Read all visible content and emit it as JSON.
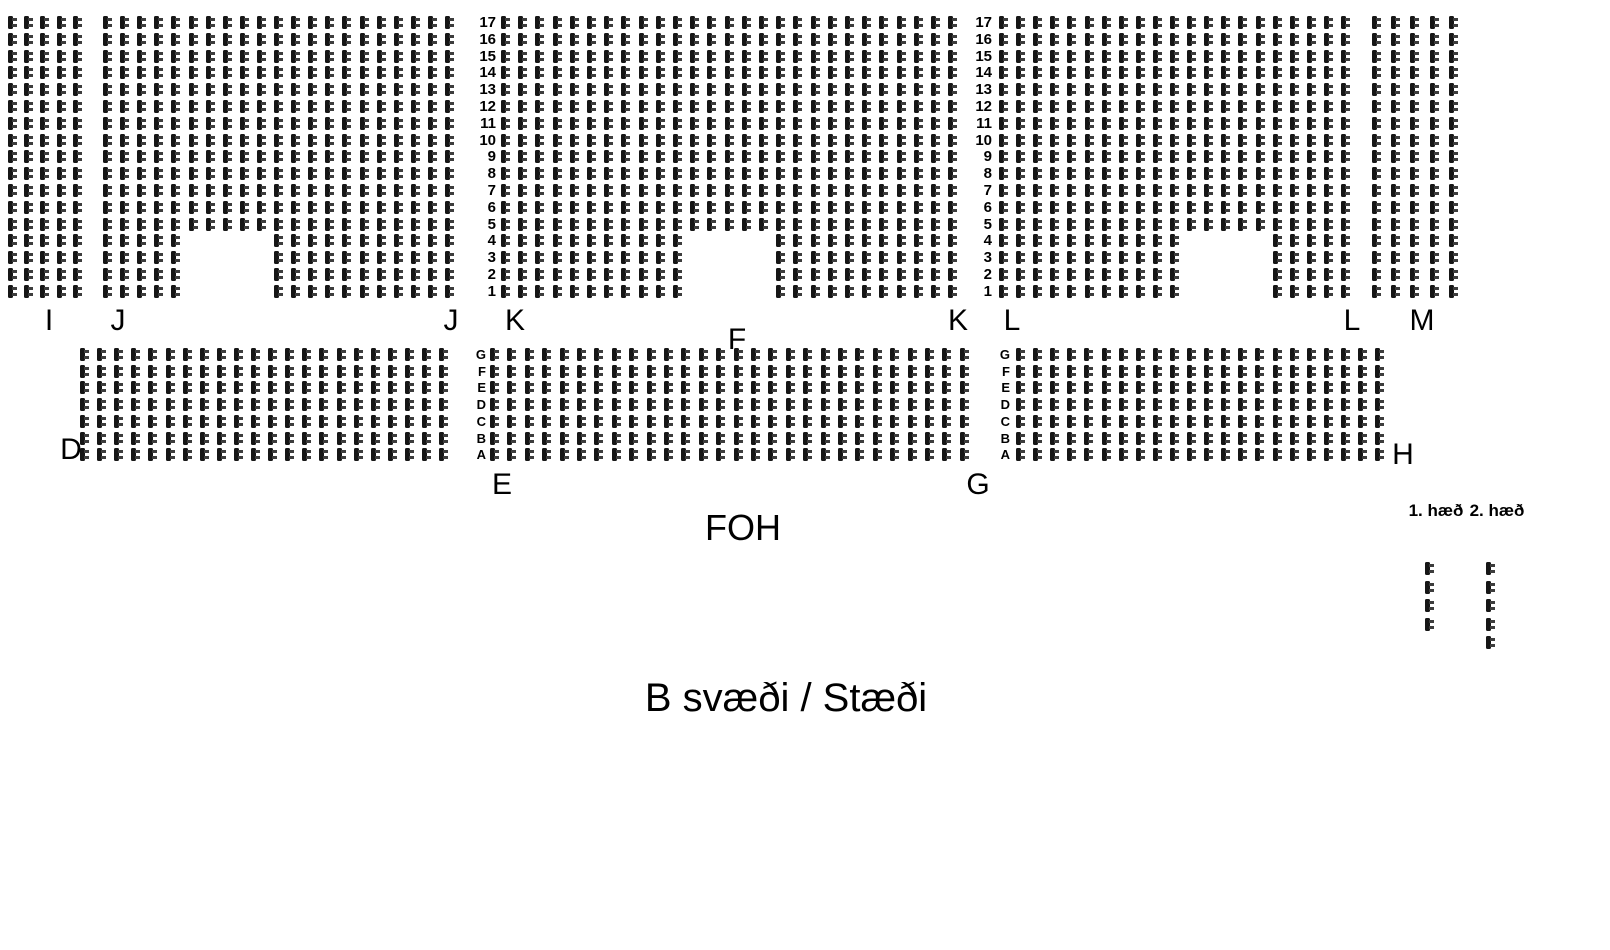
{
  "title": "B svæði / Stæði",
  "foh_label": "FOH",
  "legend": {
    "floor1_label": "1. hæð",
    "floor2_label": "2. hæð",
    "seat_columns": [
      {
        "name": "floor1-sample-seats",
        "x": 1425,
        "y_start": 562,
        "spacing": 18.5,
        "count": 4
      },
      {
        "name": "floor2-sample-seats",
        "x": 1486,
        "y_start": 562,
        "spacing": 18.5,
        "count": 5
      }
    ]
  },
  "seat_style": {
    "color": "#161616",
    "accent": "#3d3d3d",
    "width": 10,
    "height": 13
  },
  "top_band": {
    "rows": 17,
    "row_numbers_top_to_bottom": [
      "17",
      "16",
      "15",
      "14",
      "13",
      "12",
      "11",
      "10",
      "9",
      "8",
      "7",
      "6",
      "5",
      "4",
      "3",
      "2",
      "1"
    ]
  },
  "middle_band": {
    "rows": 7,
    "row_letters_top_to_bottom": [
      "G",
      "F",
      "E",
      "D",
      "C",
      "B",
      "A"
    ]
  },
  "sections": [
    {
      "name": "I",
      "x": 8,
      "y": 16,
      "rows": 17,
      "cols": 5,
      "col_spacing": 16.2,
      "row_spacing": 16.8
    },
    {
      "name": "J",
      "x": 103,
      "y": 16,
      "rows": 17,
      "cols": 21,
      "col_spacing": 17.1,
      "row_spacing": 16.8,
      "cutout": {
        "bottom_rows": 4,
        "from_col": 6,
        "to_col": 10
      }
    },
    {
      "name": "K-F",
      "x": 501,
      "y": 16,
      "rows": 17,
      "cols": 27,
      "col_spacing": 17.2,
      "row_spacing": 16.8,
      "cutout": {
        "bottom_rows": 4,
        "from_col": 12,
        "to_col": 16
      }
    },
    {
      "name": "L",
      "x": 999,
      "y": 16,
      "rows": 17,
      "cols": 21,
      "col_spacing": 17.1,
      "row_spacing": 16.8,
      "cutout": {
        "bottom_rows": 4,
        "from_col": 12,
        "to_col": 16
      }
    },
    {
      "name": "M",
      "x": 1372,
      "y": 16,
      "rows": 17,
      "cols": 5,
      "col_spacing": 19.2,
      "row_spacing": 16.8
    },
    {
      "name": "D-block",
      "x": 80,
      "y": 348,
      "rows": 7,
      "cols": 22,
      "col_spacing": 17.1,
      "row_spacing": 16.7
    },
    {
      "name": "EG-block",
      "x": 490,
      "y": 348,
      "rows": 7,
      "cols": 28,
      "col_spacing": 17.4,
      "row_spacing": 16.7
    },
    {
      "name": "H-block",
      "x": 1016,
      "y": 348,
      "rows": 7,
      "cols": 22,
      "col_spacing": 17.1,
      "row_spacing": 16.7
    }
  ],
  "axis_columns": [
    {
      "name": "row-numbers-left",
      "type": "numbers",
      "x_right": 496,
      "y_start": 16,
      "spacing": 16.8,
      "values": [
        "17",
        "16",
        "15",
        "14",
        "13",
        "12",
        "11",
        "10",
        "9",
        "8",
        "7",
        "6",
        "5",
        "4",
        "3",
        "2",
        "1"
      ]
    },
    {
      "name": "row-numbers-right",
      "type": "numbers",
      "x_right": 992,
      "y_start": 16,
      "spacing": 16.8,
      "values": [
        "17",
        "16",
        "15",
        "14",
        "13",
        "12",
        "11",
        "10",
        "9",
        "8",
        "7",
        "6",
        "5",
        "4",
        "3",
        "2",
        "1"
      ]
    },
    {
      "name": "row-letters-left",
      "type": "letters",
      "x_right": 486,
      "y_start": 348,
      "spacing": 16.7,
      "values": [
        "G",
        "F",
        "E",
        "D",
        "C",
        "B",
        "A"
      ]
    },
    {
      "name": "row-letters-right",
      "type": "letters",
      "x_right": 1010,
      "y_start": 348,
      "spacing": 16.7,
      "values": [
        "G",
        "F",
        "E",
        "D",
        "C",
        "B",
        "A"
      ]
    }
  ],
  "section_labels": [
    {
      "id": "label-i",
      "text": "I",
      "x": 49,
      "y": 306
    },
    {
      "id": "label-j-left",
      "text": "J",
      "x": 118,
      "y": 306
    },
    {
      "id": "label-j-right",
      "text": "J",
      "x": 451,
      "y": 306
    },
    {
      "id": "label-k-left",
      "text": "K",
      "x": 515,
      "y": 306
    },
    {
      "id": "label-f",
      "text": "F",
      "x": 737,
      "y": 325
    },
    {
      "id": "label-k-right",
      "text": "K",
      "x": 958,
      "y": 306
    },
    {
      "id": "label-l-left",
      "text": "L",
      "x": 1012,
      "y": 306
    },
    {
      "id": "label-l-right",
      "text": "L",
      "x": 1352,
      "y": 306
    },
    {
      "id": "label-m",
      "text": "M",
      "x": 1422,
      "y": 306
    },
    {
      "id": "label-d",
      "text": "D",
      "x": 71,
      "y": 435
    },
    {
      "id": "label-e",
      "text": "E",
      "x": 502,
      "y": 470
    },
    {
      "id": "label-g",
      "text": "G",
      "x": 978,
      "y": 470
    },
    {
      "id": "label-h",
      "text": "H",
      "x": 1403,
      "y": 440
    }
  ]
}
